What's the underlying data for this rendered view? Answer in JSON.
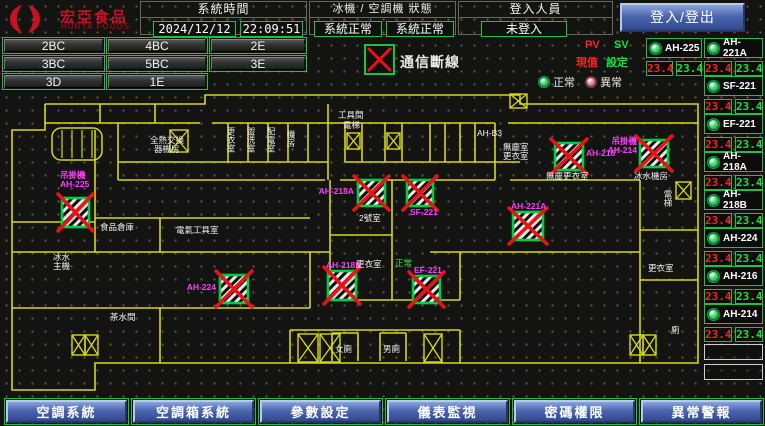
{
  "header": {
    "brand": "宏亞食品",
    "brand_en": "HUNYA FOODS",
    "system_time": {
      "label": "系統時間",
      "date": "2024/12/12",
      "time": "22:09:51"
    },
    "machine_status": {
      "label": "冰機 / 空調機 狀態",
      "chiller": "系統正常",
      "ahu": "系統正常"
    },
    "login": {
      "label": "登入人員",
      "value": "未登入",
      "button": "登入/登出"
    }
  },
  "floor_buttons": {
    "rows": [
      [
        "2BC",
        "4BC",
        "2E"
      ],
      [
        "3BC",
        "5BC",
        "3E"
      ],
      [
        "3D",
        "1E"
      ]
    ]
  },
  "legend": {
    "comm_loss": "通信斷線",
    "pv": "PV",
    "sv": "SV",
    "pv_label": "現值",
    "sv_label": "設定",
    "normal": "正常",
    "abnormal": "異常"
  },
  "sidebar": {
    "units": [
      {
        "name": "AH-225",
        "pv": "23.4",
        "sv": "23.4"
      },
      {
        "name": "AH-221A",
        "pv": "23.4",
        "sv": "23.4"
      },
      {
        "name": "SF-221",
        "pv": "23.4",
        "sv": "23.4"
      },
      {
        "name": "EF-221",
        "pv": "23.4",
        "sv": "23.4"
      },
      {
        "name": "AH-218A",
        "pv": "23.4",
        "sv": "23.4"
      },
      {
        "name": "AH-218B",
        "pv": "23.4",
        "sv": "23.4"
      },
      {
        "name": "AH-224",
        "pv": "23.4",
        "sv": "23.4"
      },
      {
        "name": "AH-216",
        "pv": "23.4",
        "sv": "23.4"
      },
      {
        "name": "AH-214",
        "pv": "23.4",
        "sv": "23.4"
      }
    ]
  },
  "map": {
    "colors": {
      "wall": "#d8d818",
      "magenta": "#ff3cff",
      "green_text": "#33dd55",
      "white": "#f2f2f2",
      "red": "#e81414",
      "box_border": "#00cc44"
    },
    "walls": [
      "M45,14 H205 V5 H520 V14 H698 V273 H95 V300 H12 V40 H45 V14",
      "M45,33 H200 M212,33 H495 M508,33 H698",
      "M228,33 V72 M248,33 V72 M268,33 V72 M288,33 V72 M308,33 V72 M328,14 V90 M345,33 V72 M362,33 V72 M385,33 V72 M402,33 V72 M430,33 V72 M445,33 V72 M460,33 V72 M475,33 V72 M100,14 V33 M155,14 V33",
      "M118,72 H328 M345,72 H520",
      "M118,90 H325 M340,90 H495 M510,90 H640",
      "M118,33 V90 M95,40 V162 M12,132 H95 M95,128 H310 M160,128 V162",
      "M12,162 H330 M430,162 H640",
      "M330,90 V210 M392,90 V210 M330,145 H392 M330,210 H392 M392,210 H460 M460,162 V210",
      "M495,33 V90 M640,90 V273 M640,140 H698 M640,190 H698",
      "M95,218 H310 M310,162 V218 M290,240 H460 M290,240 V273 M460,240 V273 M160,218 V273 M12,218 H95",
      "M332,243 V271 M358,243 V271 M332,243 H358 M380,243 V271 M406,243 V271 M380,243 H406"
    ],
    "equipment": [
      {
        "x": 62,
        "y": 108,
        "w": 27,
        "h": 29,
        "lines": [
          "吊掛機",
          "AH-225"
        ],
        "lx": 60,
        "ly": 88,
        "anchor": "start"
      },
      {
        "x": 358,
        "y": 90,
        "w": 27,
        "h": 26,
        "lines": [
          "AH-218A"
        ],
        "lx": 354,
        "ly": 104,
        "anchor": "end"
      },
      {
        "x": 407,
        "y": 90,
        "w": 26,
        "h": 26,
        "lines": [
          "SF-221"
        ],
        "lx": 410,
        "ly": 125,
        "anchor": "start"
      },
      {
        "x": 328,
        "y": 181,
        "w": 28,
        "h": 29,
        "lines": [
          "AH-218B"
        ],
        "lx": 326,
        "ly": 178,
        "anchor": "start"
      },
      {
        "x": 413,
        "y": 186,
        "w": 27,
        "h": 27,
        "lines": [
          "EF-221"
        ],
        "lx": 414,
        "ly": 183,
        "anchor": "start"
      },
      {
        "x": 220,
        "y": 185,
        "w": 28,
        "h": 28,
        "lines": [
          "AH-224"
        ],
        "lx": 216,
        "ly": 200,
        "anchor": "end"
      },
      {
        "x": 513,
        "y": 122,
        "w": 30,
        "h": 28,
        "lines": [
          "AH-221A"
        ],
        "lx": 511,
        "ly": 119,
        "anchor": "start"
      },
      {
        "x": 555,
        "y": 53,
        "w": 28,
        "h": 27,
        "lines": [
          "AH-216"
        ],
        "lx": 586,
        "ly": 66,
        "anchor": "start"
      },
      {
        "x": 640,
        "y": 50,
        "w": 28,
        "h": 27,
        "lines": [
          "吊掛機",
          "AH-214"
        ],
        "lx": 637,
        "ly": 54,
        "anchor": "end"
      }
    ],
    "room_labels": [
      {
        "t": "工具間",
        "x": 338,
        "y": 28
      },
      {
        "t": "電梯",
        "x": 343,
        "y": 38
      },
      {
        "t": "AH-B3",
        "x": 477,
        "y": 46
      },
      {
        "t": "全熱交換",
        "x": 150,
        "y": 53
      },
      {
        "t": "器機房",
        "x": 154,
        "y": 62
      },
      {
        "t": "無塵室",
        "x": 503,
        "y": 60
      },
      {
        "t": "更衣室",
        "x": 503,
        "y": 69
      },
      {
        "t": "無塵更衣室",
        "x": 546,
        "y": 89
      },
      {
        "t": "冰水機房",
        "x": 634,
        "y": 89
      },
      {
        "t": "2號室",
        "x": 359,
        "y": 131
      },
      {
        "t": "更衣室",
        "x": 356,
        "y": 177
      },
      {
        "t": "正常",
        "x": 395,
        "y": 176,
        "c": "#33dd55"
      },
      {
        "t": "食品倉庫",
        "x": 100,
        "y": 140
      },
      {
        "t": "電氣工具室",
        "x": 176,
        "y": 143
      },
      {
        "t": "冰水",
        "x": 53,
        "y": 170
      },
      {
        "t": "主機",
        "x": 53,
        "y": 179
      },
      {
        "t": "茶水間",
        "x": 110,
        "y": 230
      },
      {
        "t": "女廁",
        "x": 335,
        "y": 262
      },
      {
        "t": "男廁",
        "x": 383,
        "y": 262
      },
      {
        "t": "更衣室",
        "x": 648,
        "y": 181
      },
      {
        "t": "電梯",
        "x": 668,
        "y": 100,
        "vert": true
      },
      {
        "t": "廁",
        "x": 671,
        "y": 243
      },
      {
        "t": "更衣室",
        "x": 231,
        "y": 37,
        "vert": true
      },
      {
        "t": "盥洗室",
        "x": 251,
        "y": 37,
        "vert": true
      },
      {
        "t": "配電室",
        "x": 271,
        "y": 37,
        "vert": true
      },
      {
        "t": "機房",
        "x": 291,
        "y": 40,
        "vert": true
      }
    ],
    "shafts": [
      [
        170,
        40,
        18,
        22
      ],
      [
        347,
        43,
        13,
        16
      ],
      [
        387,
        43,
        13,
        16
      ],
      [
        510,
        4,
        17,
        14
      ],
      [
        676,
        92,
        15,
        17
      ],
      [
        298,
        244,
        20,
        28
      ],
      [
        320,
        244,
        20,
        28
      ],
      [
        424,
        244,
        18,
        28
      ],
      [
        72,
        245,
        13,
        20
      ],
      [
        85,
        245,
        13,
        20
      ],
      [
        630,
        245,
        13,
        20
      ],
      [
        643,
        245,
        13,
        20
      ]
    ],
    "stairs": [
      [
        52,
        38,
        50,
        32
      ]
    ]
  },
  "bottom_nav": [
    "空調系統",
    "空調箱系統",
    "參數設定",
    "儀表監視",
    "密碼權限",
    "異常警報"
  ]
}
